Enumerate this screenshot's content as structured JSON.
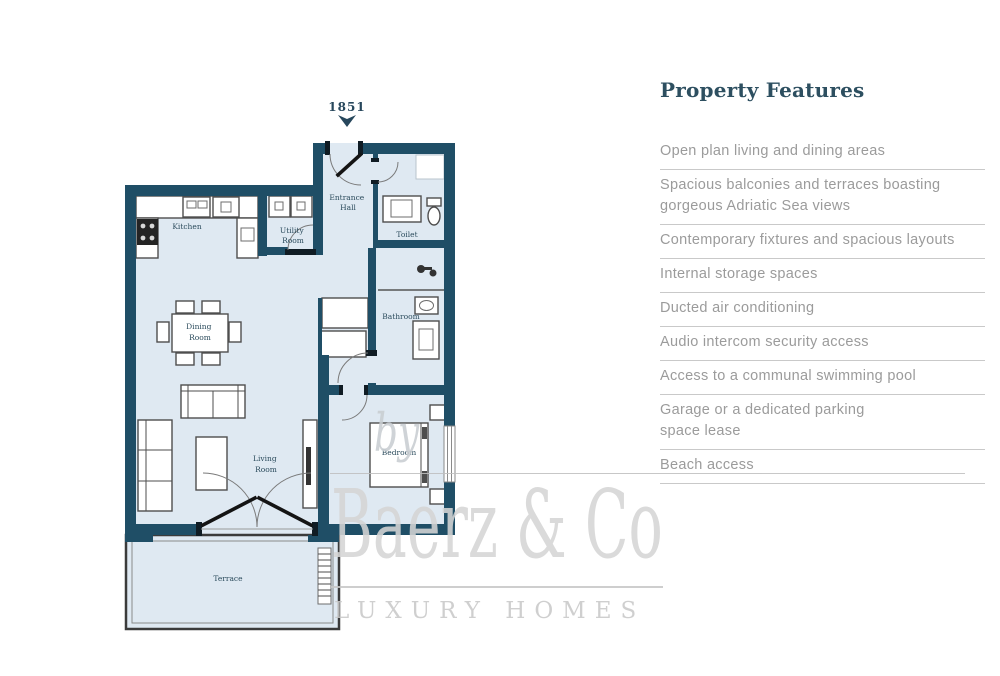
{
  "plan": {
    "unit_number": "1851",
    "rooms": {
      "kitchen": [
        "Kitchen"
      ],
      "utility": [
        "Utility",
        "Room"
      ],
      "entrance": [
        "Entrance",
        "Hall"
      ],
      "toilet": [
        "Toilet"
      ],
      "bathroom": [
        "Bathroom"
      ],
      "dining": [
        "Dining",
        "Room"
      ],
      "living": [
        "Living",
        "Room"
      ],
      "bedroom": [
        "Bedroom"
      ],
      "terrace": [
        "Terrace"
      ]
    }
  },
  "features": {
    "title": "Property Features",
    "items": [
      [
        "Open plan living and dining areas"
      ],
      [
        "Spacious balconies and terraces boasting",
        "gorgeous Adriatic Sea views"
      ],
      [
        "Contemporary fixtures and spacious layouts"
      ],
      [
        "Internal storage spaces"
      ],
      [
        "Ducted air conditioning"
      ],
      [
        "Audio intercom security access"
      ],
      [
        "Access to a communal swimming pool"
      ],
      [
        "Garage or a dedicated parking",
        "space lease"
      ],
      [
        "Beach access"
      ]
    ]
  },
  "watermark": {
    "prefix": "by",
    "brand": "Baerz & Co",
    "tagline": "LUXURY HOMES"
  },
  "colors": {
    "wall": "#1f4e66",
    "floor": "#dfe9f2",
    "room_label": "#2b4b5c",
    "features_title": "#2d4f60",
    "features_text": "#9b9b9b",
    "divider": "#c9c9c9",
    "watermark": "#d5d5d5"
  }
}
